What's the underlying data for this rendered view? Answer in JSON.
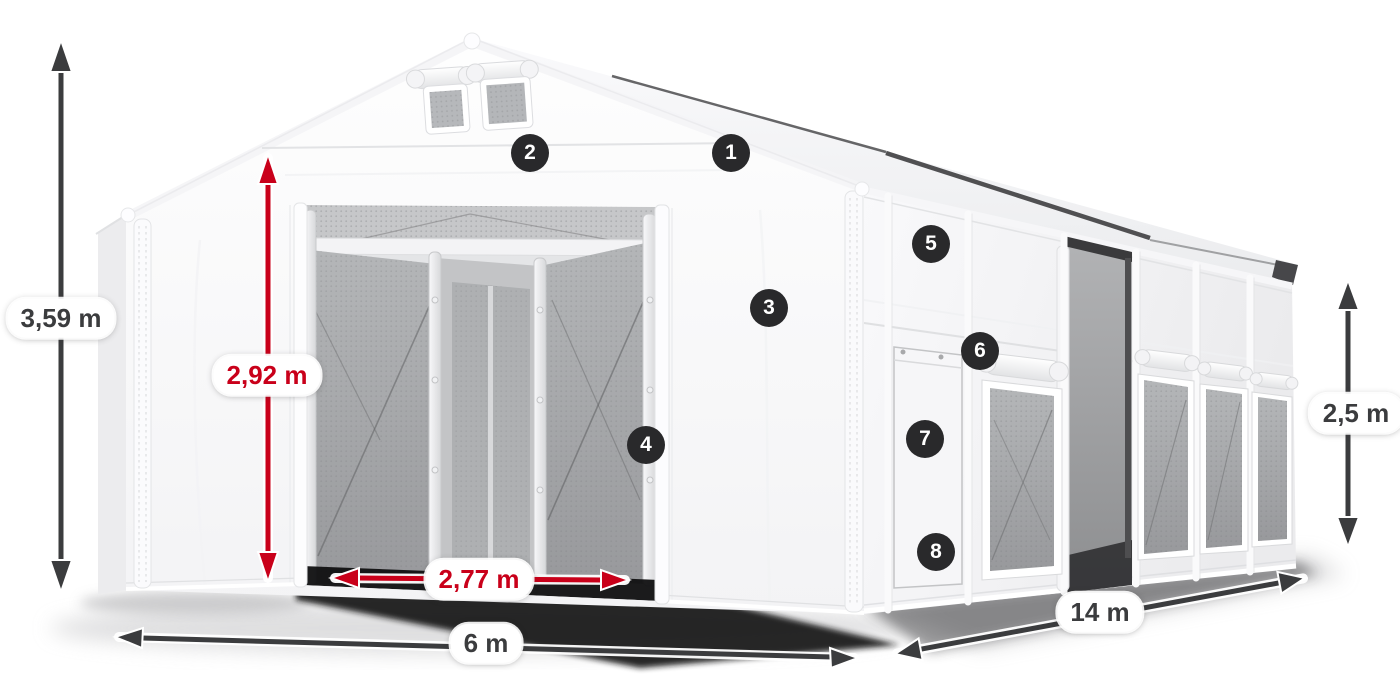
{
  "colors": {
    "accent_red": "#c9001a",
    "dimension_ink": "#3b3c3e",
    "badge_bg": "#29292b",
    "badge_text": "#ffffff"
  },
  "dimensions": {
    "total_height": {
      "label": "3,59 m",
      "style": "dark"
    },
    "door_height": {
      "label": "2,92 m",
      "style": "red"
    },
    "door_width": {
      "label": "2,77 m",
      "style": "red"
    },
    "front_width": {
      "label": "6 m",
      "style": "dark"
    },
    "side_length": {
      "label": "14 m",
      "style": "dark"
    },
    "side_height": {
      "label": "2,5 m",
      "style": "dark"
    }
  },
  "callouts": [
    {
      "number": "1"
    },
    {
      "number": "2"
    },
    {
      "number": "3"
    },
    {
      "number": "4"
    },
    {
      "number": "5"
    },
    {
      "number": "6"
    },
    {
      "number": "7"
    },
    {
      "number": "8"
    }
  ]
}
